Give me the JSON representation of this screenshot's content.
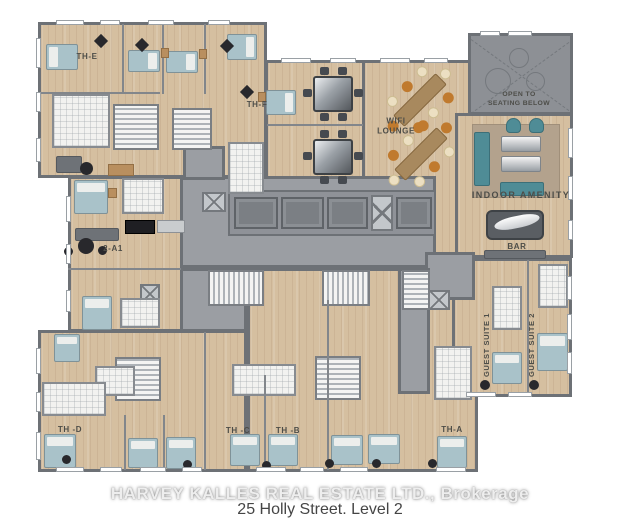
{
  "plan": {
    "caption": "25 Holly Street. Level 2",
    "watermark": "HARVEY KALLES REAL ESTATE LTD., Brokerage"
  },
  "rooms": [
    {
      "id": "th-e",
      "label": "TH-E"
    },
    {
      "id": "th-f",
      "label": "TH-F"
    },
    {
      "id": "unit-2-a1",
      "label": "2-A1"
    },
    {
      "id": "wifi-lounge",
      "label": "WIFI\nLOUNGE"
    },
    {
      "id": "open-to-seating-below",
      "label": "OPEN TO\nSEATING BELOW"
    },
    {
      "id": "indoor-amenity",
      "label": "INDOOR AMENITY"
    },
    {
      "id": "bar",
      "label": "BAR"
    },
    {
      "id": "guest-suite-1",
      "label": "GUEST SUITE 1"
    },
    {
      "id": "guest-suite-2",
      "label": "GUEST SUITE 2"
    },
    {
      "id": "th-d",
      "label": "TH -D"
    },
    {
      "id": "th-c",
      "label": "TH -C"
    },
    {
      "id": "th-b",
      "label": "TH -B"
    },
    {
      "id": "th-a",
      "label": "TH-A"
    }
  ],
  "colors": {
    "wall": "#6d7176",
    "floor": "#d5bfa0",
    "corridor": "#9b9ea3",
    "open_area": "#8d9095",
    "bathroom": "#f2f2f0",
    "bed": "#a9c2c9",
    "teal": "#4f8c96",
    "chair_orange": "#c07a2e",
    "chair_cream": "#ecdfc2",
    "wood_table": "#a8895e",
    "label_text": "#4d4d48"
  }
}
